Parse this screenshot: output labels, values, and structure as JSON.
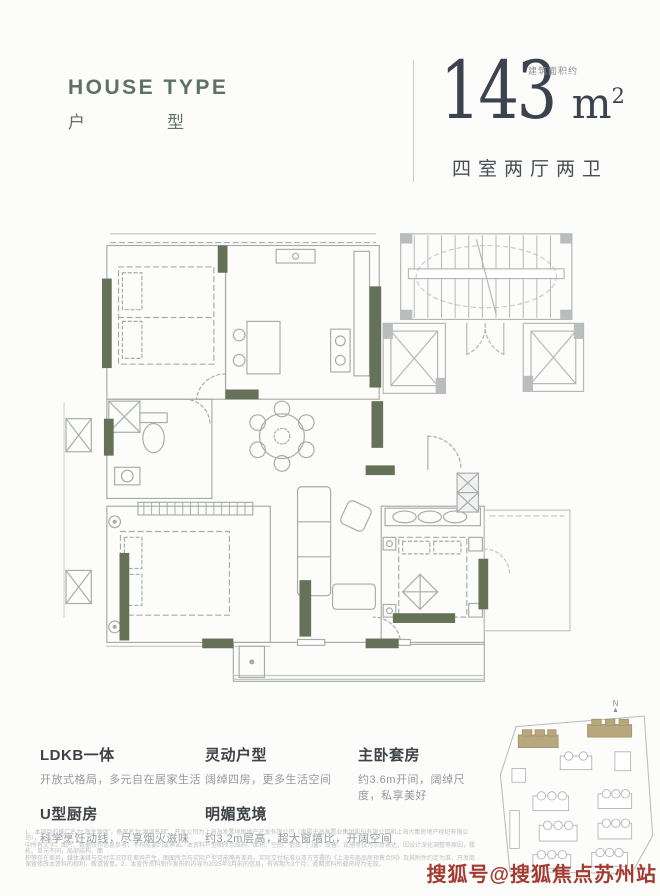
{
  "header": {
    "title_en": "HOUSE TYPE",
    "title_cn_1": "户",
    "title_cn_2": "型",
    "area_number": "143",
    "area_unit": "m",
    "area_sup": "2",
    "area_note": "建筑面积约",
    "layout_desc": "四室两厅两卫"
  },
  "features": {
    "items": [
      {
        "title": "LDKB一体",
        "desc": "开放式格局，多元自在居家生活"
      },
      {
        "title": "U型厨房",
        "desc": "科学烹饪动线，尽享烟火滋味"
      },
      {
        "title": "灵动户型",
        "desc": "阔绰四房，更多生活空间"
      },
      {
        "title": "明媚宽境",
        "desc": "约3.2m层高，超大窗墙比，开阔空间"
      },
      {
        "title": "主卧套房",
        "desc": "约3.6m开间，阔绰尺度，私享美好"
      }
    ]
  },
  "siteplan": {
    "north_label": "N",
    "north_arrow": "▲",
    "highlight_color": "#b8a77c"
  },
  "disclaimer": {
    "lines": [
      "1、本项目的推广名为“海发源颂”，备案名为“源颂名邸”，开发公司为上海海发置地房地产开发有限公司（隶属于海发置业集团股份有限公司和上海大集房地产经纪有限公司），本宣传资料",
      "中所有文字、图片、数据仅作信息参考，不构成要约或承诺。本资料户型图所示结构、面积、空间、管线、门窗、设备、设施等仅为示意表达，因设计深化调整等原因，楼栋、单元不同，局部结构、面",
      "积等存在差异，媒体演绎与交付实况存在差异产生，图面所示与实际户型可能略有差异。实际交付标准以双方签署的《上海市商品房预售合同》及其附件约定为准，开发商",
      "保留修改本资料的权利，敬请留意。2、本宣传资料制作发布的内容为2025年3月前的信息，有效期为3个月，逾期资料所载将视为无效。"
    ]
  },
  "watermark": {
    "text": "搜狐号@搜狐焦点苏州站",
    "color": "#a23b32"
  },
  "colors": {
    "accent_wall_green": "#657257",
    "title_green": "#5e7164",
    "number_dark": "#3c434e",
    "feature_title": "#3e4246",
    "feature_desc": "#96999c",
    "core_gray": "#b9bdbd",
    "plan_line": "#a7aca9",
    "highlight_tan": "#b8a77c",
    "watermark_red": "#a23b32"
  }
}
